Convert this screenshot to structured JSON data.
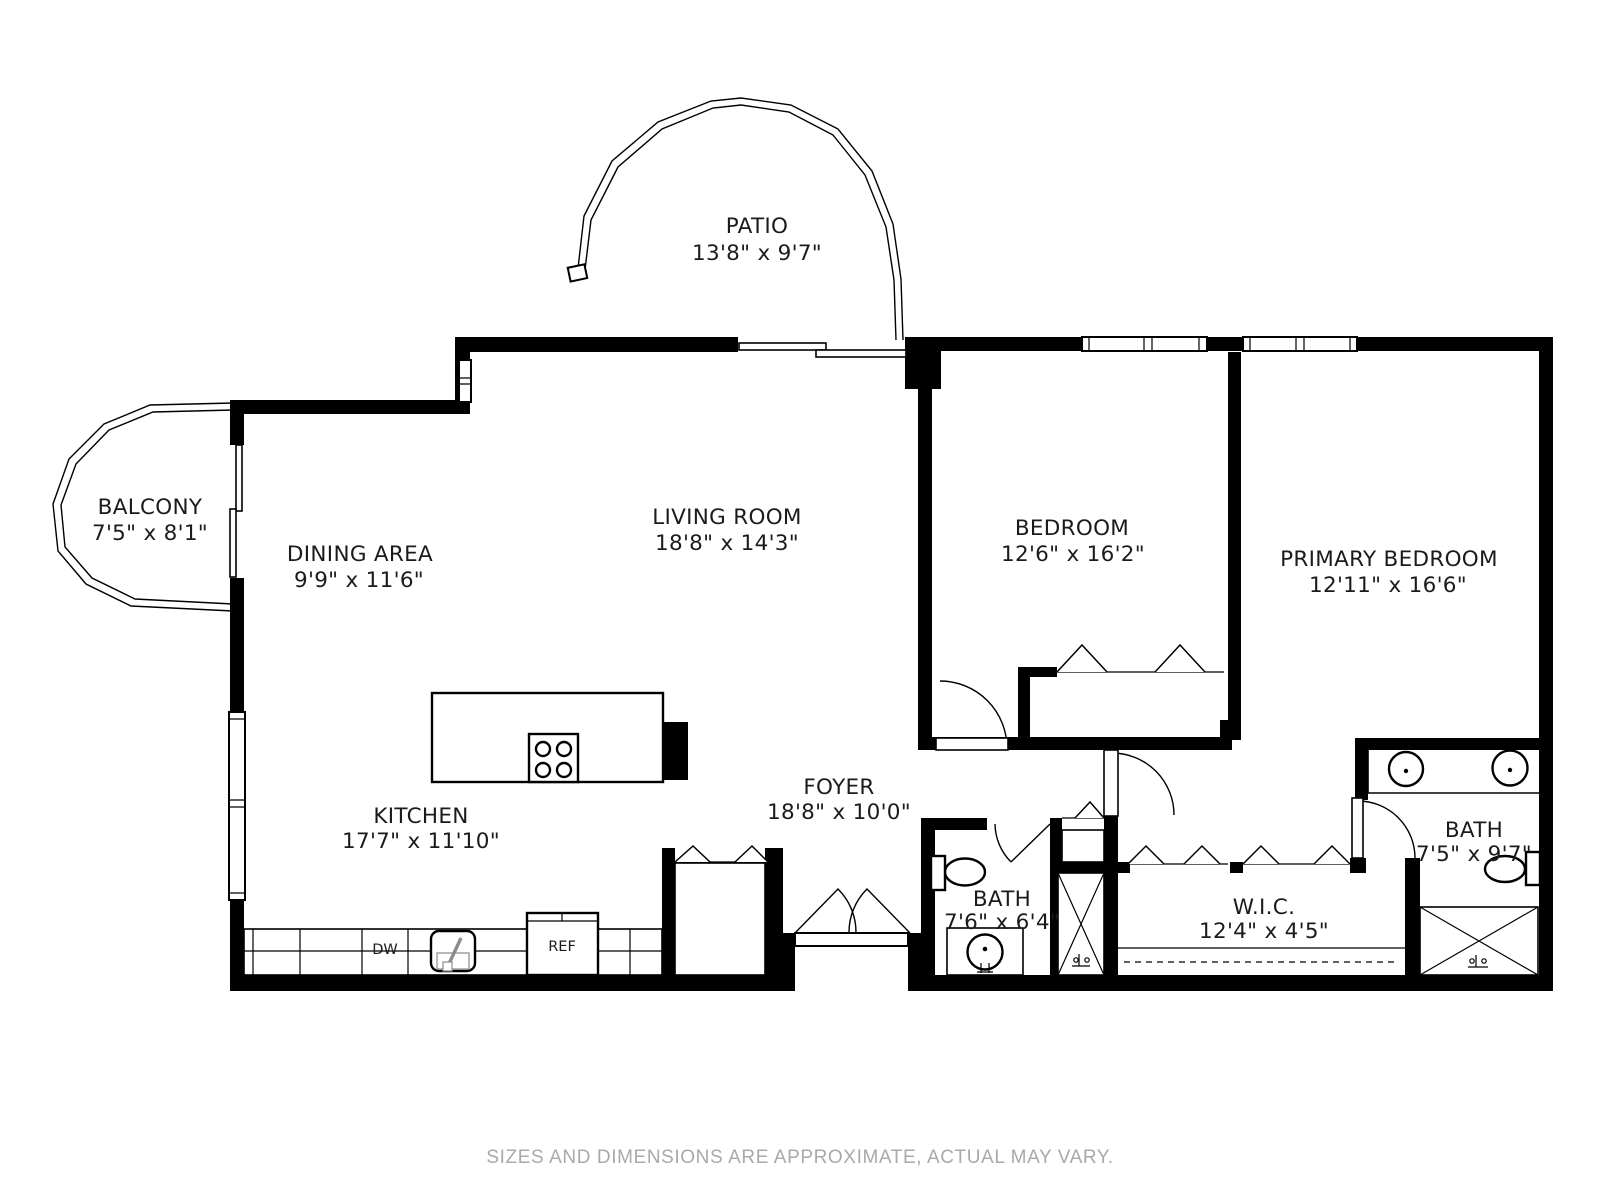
{
  "rooms": {
    "patio": {
      "label": "PATIO",
      "dims": "13'8\" x 9'7\""
    },
    "balcony": {
      "label": "BALCONY",
      "dims": "7'5\" x 8'1\""
    },
    "dining": {
      "label": "DINING AREA",
      "dims": "9'9\" x 11'6\""
    },
    "living": {
      "label": "LIVING ROOM",
      "dims": "18'8\" x 14'3\""
    },
    "bedroom": {
      "label": "BEDROOM",
      "dims": "12'6\" x 16'2\""
    },
    "primary_bedroom": {
      "label": "PRIMARY BEDROOM",
      "dims": "12'11\" x 16'6\""
    },
    "kitchen": {
      "label": "KITCHEN",
      "dims": "17'7\" x 11'10\""
    },
    "foyer": {
      "label": "FOYER",
      "dims": "18'8\" x 10'0\""
    },
    "bath": {
      "label": "BATH",
      "dims": "7'6\" x 6'4\""
    },
    "wic": {
      "label": "W.I.C.",
      "dims": "12'4\" x 4'5\""
    },
    "primary_bath": {
      "label": "BATH",
      "dims": "7'5\" x 9'7\""
    }
  },
  "appliances": {
    "refrigerator": "REF",
    "dishwasher": "DW"
  },
  "footer": {
    "disclaimer": "SIZES AND DIMENSIONS ARE APPROXIMATE, ACTUAL MAY VARY."
  },
  "colors": {
    "wall": "#000000",
    "footer_text": "#a9a9a9"
  }
}
